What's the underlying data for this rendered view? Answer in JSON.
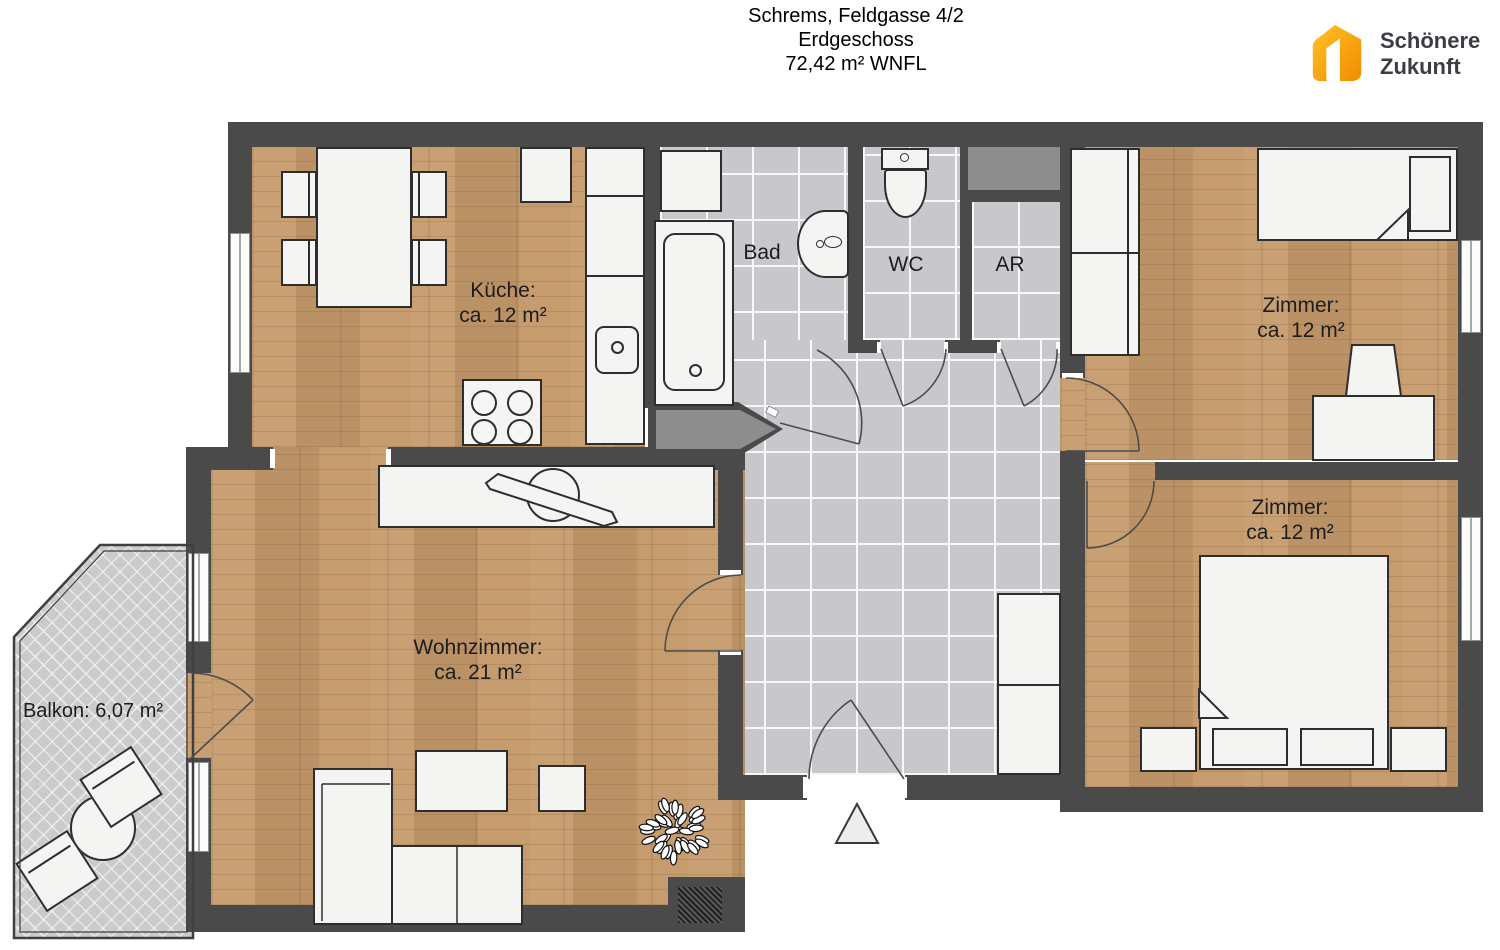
{
  "title": {
    "line1": "Schrems, Feldgasse 4/2",
    "line2": "Erdgeschoss",
    "line3": "72,42 m² WNFL"
  },
  "logo": {
    "line1": "Schönere",
    "line2": "Zukunft"
  },
  "rooms": {
    "kitchen": {
      "name": "Küche:",
      "area": "ca. 12 m²"
    },
    "bath": {
      "name": "Bad"
    },
    "wc": {
      "name": "WC"
    },
    "storage": {
      "name": "AR"
    },
    "bedroom_top": {
      "name": "Zimmer:",
      "area": "ca. 12 m²"
    },
    "bedroom_bottom": {
      "name": "Zimmer:",
      "area": "ca. 12 m²"
    },
    "living": {
      "name": "Wohnzimmer:",
      "area": "ca. 21 m²"
    },
    "balcony": {
      "name": "Balkon: 6,07 m²"
    }
  },
  "colors": {
    "wall": "#4A4A4A",
    "wood_floor": "#C59A6B",
    "tile_floor": "#C8C8CC",
    "balcony_floor": "#CBCBCE",
    "brand_orange": "#F7A600",
    "brand_text": "#3C3C44"
  }
}
